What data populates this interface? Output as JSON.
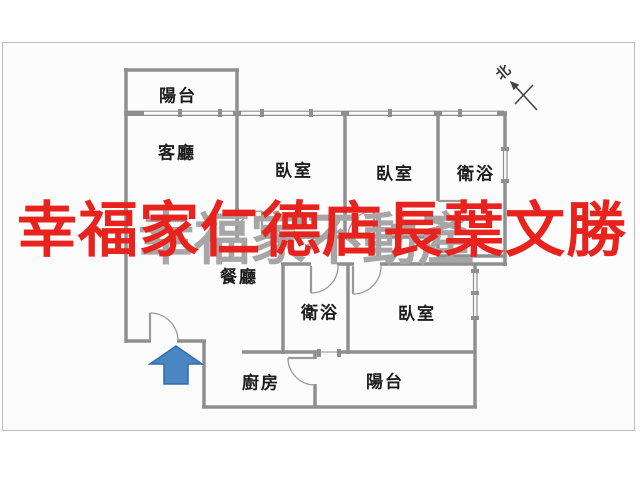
{
  "panel": {
    "background": "#fcfcfc",
    "border_color": "#bcbcbc"
  },
  "floorplan": {
    "wall_color": "#8f8f8f",
    "label_color": "#1c1c1c",
    "rooms": [
      {
        "id": "balcony-top",
        "label": "陽台"
      },
      {
        "id": "living-room",
        "label": "客廳"
      },
      {
        "id": "bedroom-1",
        "label": "臥室"
      },
      {
        "id": "bedroom-2",
        "label": "臥室"
      },
      {
        "id": "bathroom-1",
        "label": "衛浴"
      },
      {
        "id": "dining-room",
        "label": "餐廳"
      },
      {
        "id": "bathroom-2",
        "label": "衛浴"
      },
      {
        "id": "bedroom-3",
        "label": "臥室"
      },
      {
        "id": "kitchen",
        "label": "廚房"
      },
      {
        "id": "balcony-bottom",
        "label": "陽台"
      }
    ],
    "compass": {
      "label": "北"
    },
    "entrance_arrow": {
      "fill": "#4a85c4",
      "border": "#2f6cab"
    }
  },
  "watermarks": {
    "gray": {
      "text": "幸福家不動產",
      "color": "#a6a6a6"
    },
    "red": {
      "text": "幸福家仁德店長葉文勝",
      "color": "#e8231d"
    }
  }
}
